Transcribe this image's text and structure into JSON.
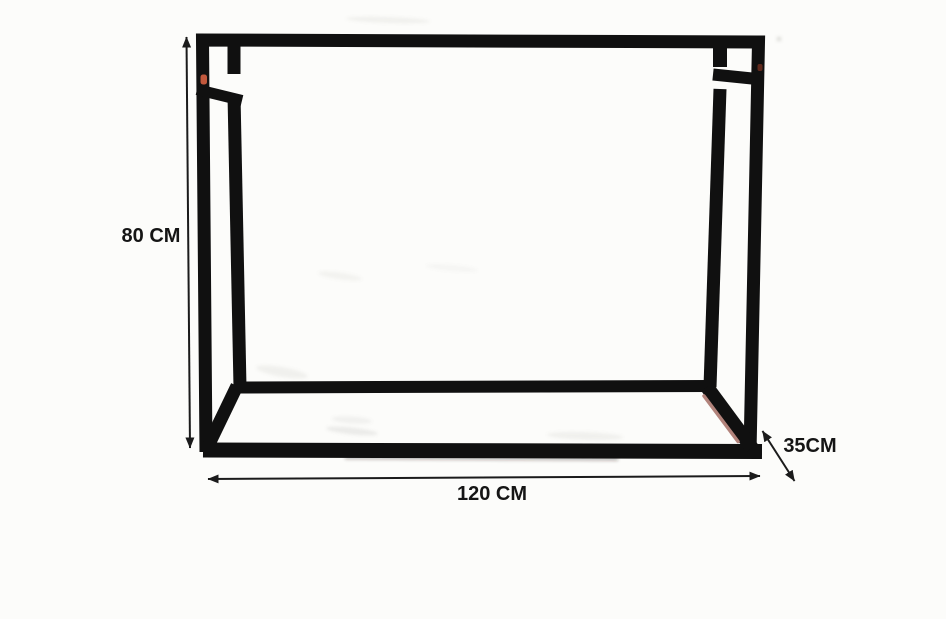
{
  "diagram": {
    "labels": {
      "height": "80 CM",
      "width": "120 CM",
      "depth": "35CM"
    },
    "colors": {
      "frame": "#101010",
      "dimension_line": "#1b1b1b",
      "label_text": "#151515",
      "copper_accent": "#b2837b",
      "joint_mark": "#c2583c",
      "background": "#fcfcfa"
    }
  }
}
